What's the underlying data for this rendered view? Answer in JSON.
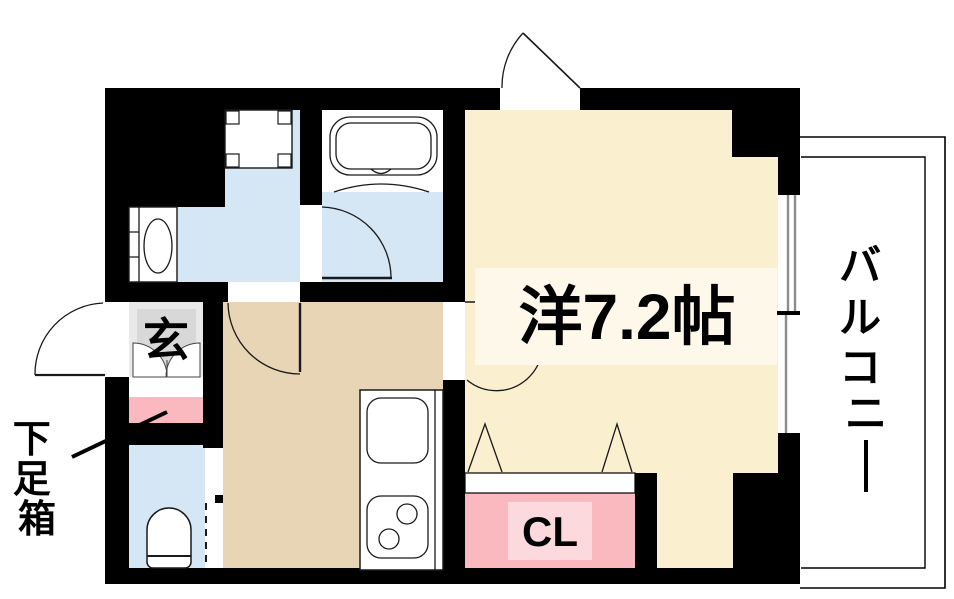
{
  "floorplan": {
    "rooms": {
      "main_room": {
        "label": "洋7.2帖"
      },
      "balcony": {
        "label": "バルコニー",
        "chars": [
          "バ",
          "ル",
          "コ",
          "ニ",
          "ー"
        ]
      },
      "entrance": {
        "label": "玄"
      },
      "closet": {
        "label": "CL"
      },
      "shoe_box": {
        "label": "下足箱",
        "chars": [
          "下",
          "足",
          "箱"
        ]
      }
    },
    "colors": {
      "wall": "#000000",
      "room_beige": "#FAEFCE",
      "room_label_box": "#FDF8EA",
      "kitchen_tan": "#E7D5B6",
      "water_blue": "#D5E6F4",
      "closet_pink": "#F9B9BF",
      "closet_label_box": "#FBD9DD",
      "entrance_gray": "#E9E9E9",
      "entrance_gray_dark": "#D8D8D8",
      "window_gray": "#8C8C8C"
    }
  }
}
